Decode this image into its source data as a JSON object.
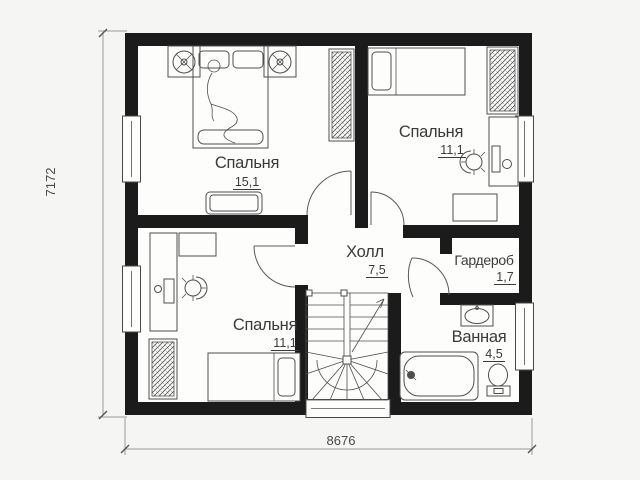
{
  "colors": {
    "wall": "#1b1b1b",
    "furniture_line": "#4f4f4f",
    "text": "#3a3a3a",
    "page_background": "#f5f5f3",
    "room_fill": "#fdfdfc"
  },
  "rooms": {
    "bedroom_tl": {
      "label": "Спальня",
      "area": "15,1",
      "furniture": [
        "double-bed",
        "person-figure",
        "nightstand-with-fan",
        "nightstand-with-fan",
        "wardrobe-hatched",
        "dresser"
      ]
    },
    "bedroom_tr": {
      "label": "Спальня",
      "area": "11,1",
      "furniture": [
        "single-bed",
        "wardrobe-hatched",
        "desk-with-monitor",
        "office-chair",
        "cabinet"
      ]
    },
    "bedroom_bl": {
      "label": "Спальня",
      "area": "11,1",
      "furniture": [
        "desk-with-monitor",
        "office-chair",
        "shelf",
        "wardrobe-hatched",
        "single-bed"
      ]
    },
    "hall": {
      "label": "Холл",
      "area": "7,5",
      "furniture": [
        "winder-staircase",
        "up-arrow"
      ]
    },
    "wardrobe": {
      "label": "Гардероб",
      "area": "1,7",
      "furniture": []
    },
    "bathroom": {
      "label": "Ванная",
      "area": "4,5",
      "furniture": [
        "bathtub",
        "wash-basin",
        "toilet"
      ]
    }
  },
  "dimensions": {
    "left": "7172",
    "bottom": "8676"
  }
}
